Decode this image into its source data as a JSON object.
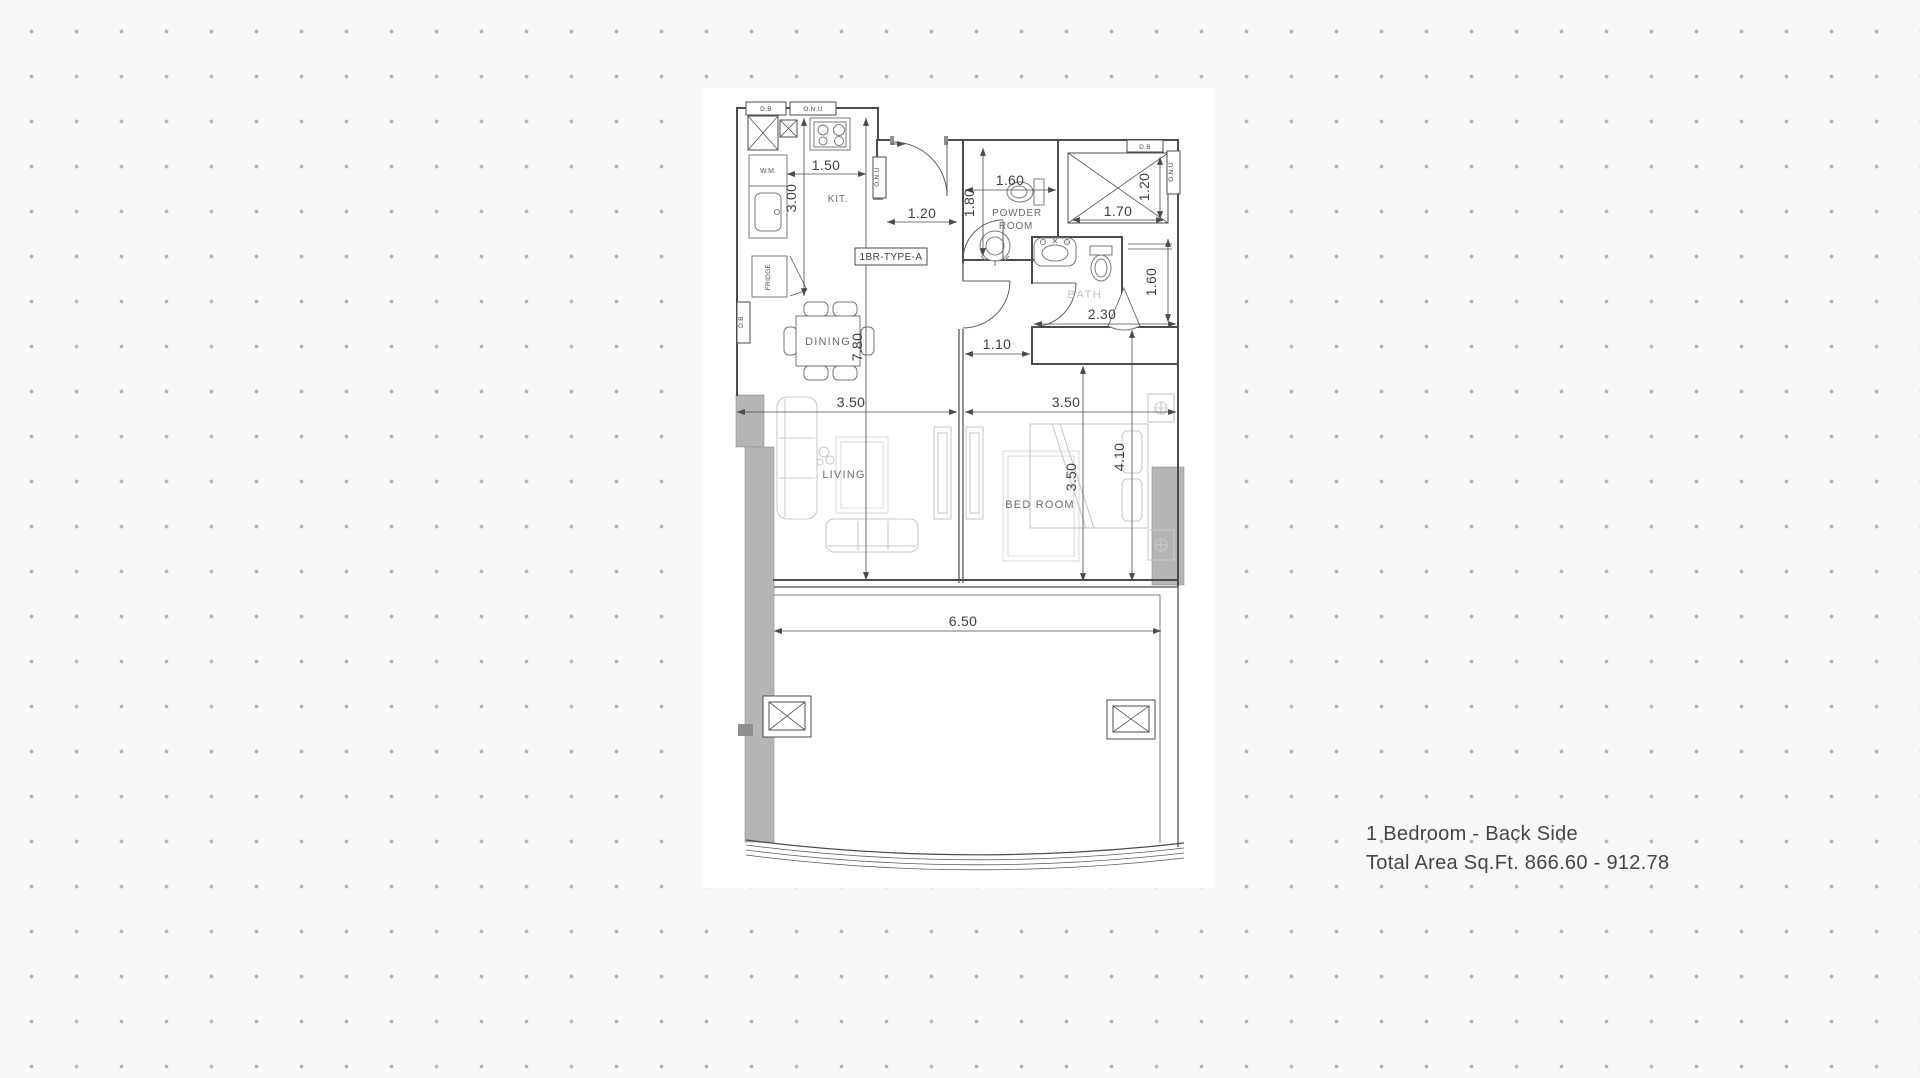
{
  "colors": {
    "wall": "#4b4b4b",
    "furniture": "#c9c9c9",
    "column_fill": "#b5b5b5",
    "caption_text": "#454545",
    "background": "#f8f8f6",
    "dot": "#b6b6b6"
  },
  "footer": {
    "line1": "1 Bedroom - Back Side",
    "line2": "Total Area Sq.Ft. 866.60 - 912.78"
  },
  "plan": {
    "unit_label": "1BR-TYPE-A",
    "rooms": {
      "kitchen": "KIT.",
      "powder_line1": "POWDER",
      "powder_line2": "ROOM",
      "bath": "BATH",
      "dining": "DINING",
      "living": "LIVING",
      "bedroom": "BED ROOM"
    },
    "appliances": {
      "wm": "W.M.",
      "fridge": "FRIDGE"
    },
    "panels": {
      "db_top": "D.B",
      "onu_top": "O.N.U",
      "onu_entry": "O.N.U",
      "db_left": "D.B",
      "db_right": "D.B",
      "onu_right": "O.N.U"
    },
    "dims": {
      "kitchen_width": "1.50",
      "kitchen_depth": "3.00",
      "overall_depth": "7.80",
      "entry_width": "1.20",
      "powder_depth": "1.80",
      "powder_width": "1.60",
      "shaft_width": "1.70",
      "shaft_depth": "1.20",
      "bath_width": "2.30",
      "bath_depth": "1.60",
      "corridor_width": "1.10",
      "living_width": "3.50",
      "bedroom_width": "3.50",
      "bedroom_length": "3.50",
      "bedroom_depth": "4.10",
      "balcony_width": "6.50"
    }
  }
}
